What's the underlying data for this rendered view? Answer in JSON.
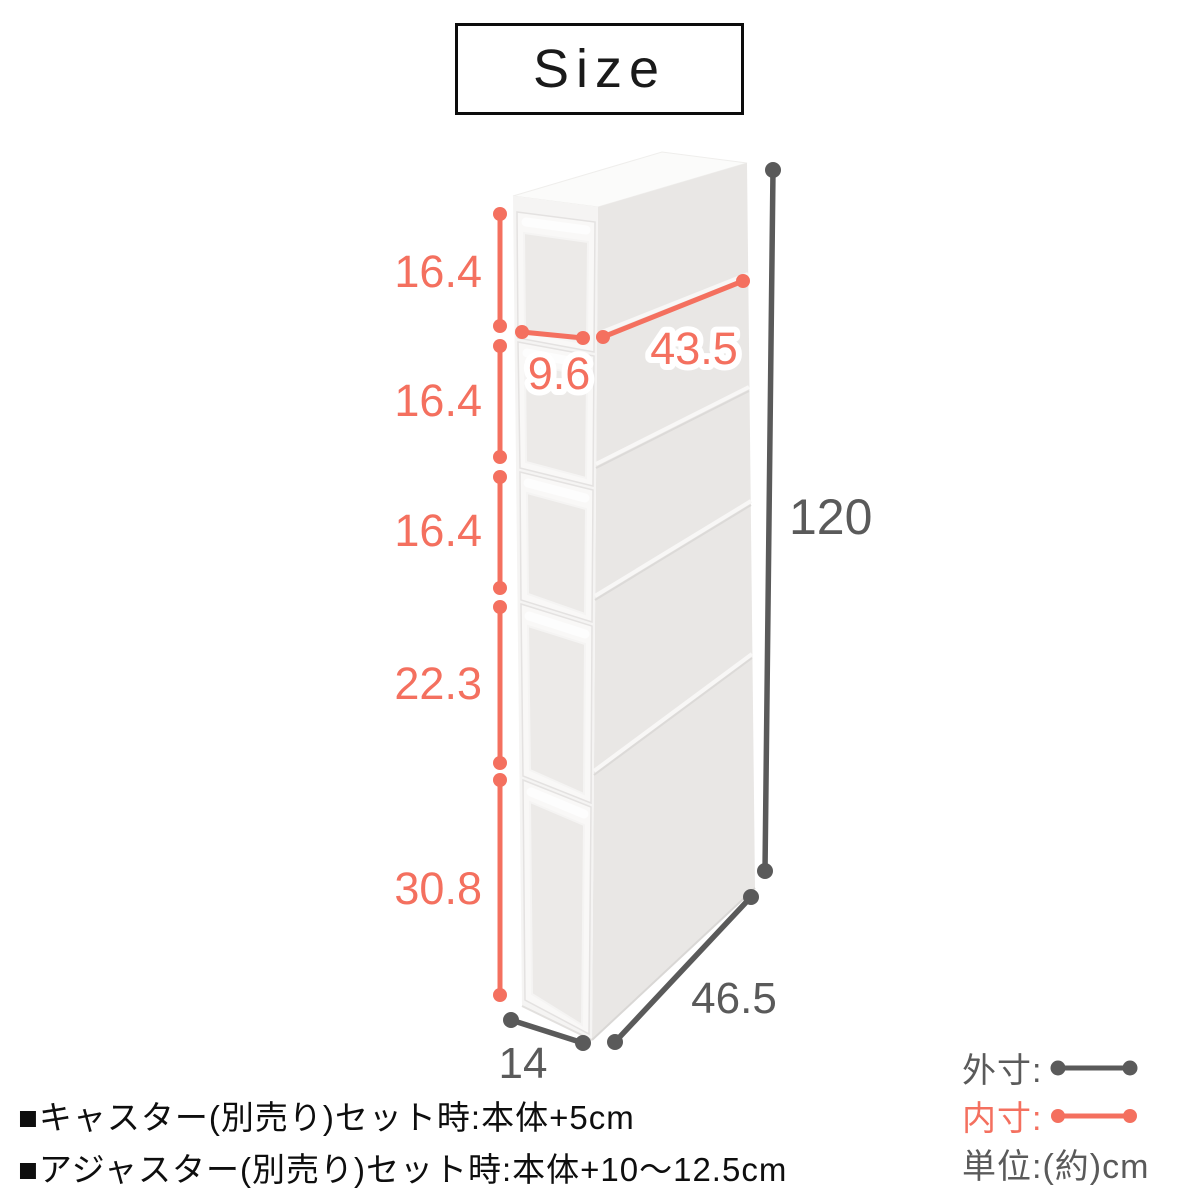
{
  "title": "Size",
  "colors": {
    "pink": "#f4705f",
    "gray": "#5a5a5a",
    "black": "#0e0e0e"
  },
  "dims": {
    "drawer_heights": [
      "16.4",
      "16.4",
      "16.4",
      "22.3",
      "30.8"
    ],
    "inner_width": "9.6",
    "inner_depth": "43.5",
    "outer_height": "120",
    "outer_width": "14",
    "outer_depth": "46.5"
  },
  "legend": {
    "outer": "外寸:",
    "inner": "内寸:",
    "unit": "単位:(約)cm"
  },
  "notes": [
    "■キャスター(別売り)セット時:本体+5cm",
    "■アジャスター(別売り)セット時:本体+10〜12.5cm"
  ]
}
